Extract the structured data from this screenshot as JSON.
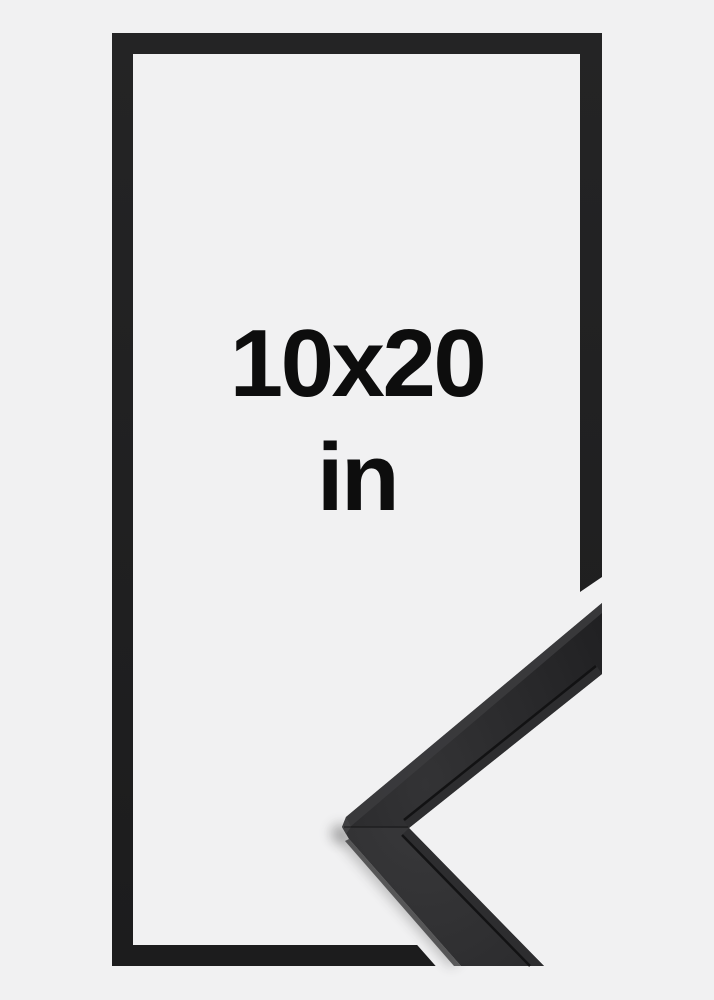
{
  "product": {
    "description": "black picture frame, front outline view with corner profile detail",
    "size_label": {
      "line1": "10x20",
      "line2": "in"
    }
  },
  "colors": {
    "background": "#f1f1f2",
    "frame_black": "#202021",
    "moulding_highlight": "#3b3b3d",
    "text": "#0d0d0d"
  }
}
